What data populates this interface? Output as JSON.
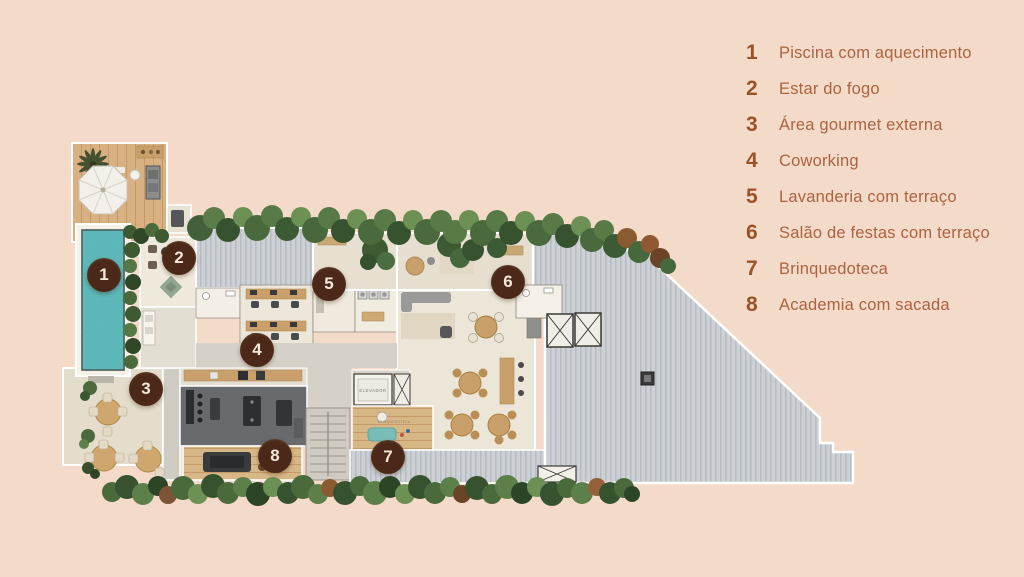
{
  "page": {
    "background_color": "#f4dbc9"
  },
  "legend": {
    "items": [
      {
        "number": "1",
        "label": "Piscina com aquecimento"
      },
      {
        "number": "2",
        "label": "Estar do fogo"
      },
      {
        "number": "3",
        "label": "Área gourmet externa"
      },
      {
        "number": "4",
        "label": "Coworking"
      },
      {
        "number": "5",
        "label": "Lavanderia com terraço"
      },
      {
        "number": "6",
        "label": "Salão de festas com terraço"
      },
      {
        "number": "7",
        "label": "Brinquedoteca"
      },
      {
        "number": "8",
        "label": "Academia com sacada"
      }
    ],
    "number_color": "#9d5226",
    "text_color": "#ac6340"
  },
  "floor_plan": {
    "markers": [
      {
        "number": "1",
        "label": "Piscina com aquecimento",
        "x": 104,
        "y": 275
      },
      {
        "number": "2",
        "label": "Estar do fogo",
        "x": 179,
        "y": 258
      },
      {
        "number": "3",
        "label": "Área gourmet externa",
        "x": 146,
        "y": 389
      },
      {
        "number": "4",
        "label": "Coworking",
        "x": 257,
        "y": 350
      },
      {
        "number": "5",
        "label": "Lavanderia com terraço",
        "x": 329,
        "y": 284
      },
      {
        "number": "6",
        "label": "Salão de festas com terraço",
        "x": 508,
        "y": 282
      },
      {
        "number": "7",
        "label": "Brinquedoteca",
        "x": 388,
        "y": 457
      },
      {
        "number": "8",
        "label": "Academia com sacada",
        "x": 275,
        "y": 456
      }
    ],
    "labels": {
      "elevator": "ELEVADOR",
      "playroom": "BRINQUEDOTECA"
    },
    "colors": {
      "marker_circle": "#4b2817",
      "marker_text": "#f3e7d8",
      "pool_water": "#58b5b6",
      "deck_wood": "#d8b081",
      "roof_metal": "#cdd1d5",
      "hedge_green": "#4a6a3c",
      "terrace_floor": "#e4ddcb"
    }
  }
}
